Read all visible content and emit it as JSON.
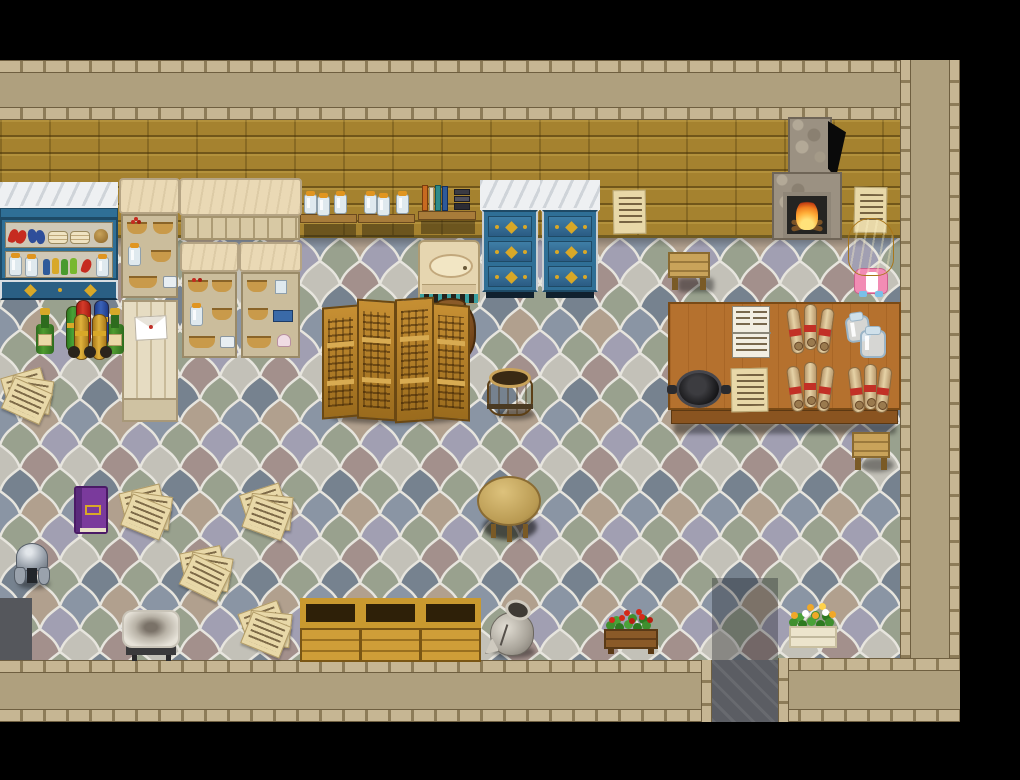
{
  "app": {
    "kind": "rpg-top-down-interior-screenshot",
    "room": "merchant shop interior with letterboard, fireplace and study table",
    "visible_text": "none (decorative pixel scribbles only)"
  },
  "palette": {
    "wall_band": "#afa07e",
    "tickA": "#c6b693",
    "wall_brick": "#a5822f",
    "furniture_blue": "#2f6f96",
    "furniture_cream": "#ead9b5",
    "accent_gold": "#d8a828",
    "table_wood": "#b5712e",
    "parchment": "#e8d8a8",
    "fire_orange": "#f08020",
    "tile_grout": "#e7e5de"
  },
  "floor": {
    "pattern": "ogee-quatrefoil tiles",
    "tile_colors": [
      "#8a95a4",
      "#b1a08e",
      "#99a18e",
      "#a19fb2",
      "#c3c1b8",
      "#a3908c",
      "#76828f"
    ]
  },
  "labels": {
    "blue_shelf": "Blue display shelf with food, plates and bottles",
    "pantry_shelf_1": "Cream pantry shelf with baskets",
    "carved_cabinet": "Wide cream cabinet with carved frieze",
    "pantry_shelf_2": "Cream pantry shelf with baskets and jars",
    "pantry_shelf_3": "Cream pantry shelf with bread and cups",
    "letter_board": "Wooden board with pinned letter",
    "wall_jar_shelf": "Wall shelves with glass jars",
    "wall_book_shelf": "Wall shelf with books",
    "washstand": "Stone washstand with basin",
    "dresser_left": "Blue dresser with lace cover",
    "dresser_right": "Blue dresser with lace cover",
    "notice_left": "Parchment notice on wall",
    "notice_right": "Parchment notice on wall",
    "fireplace": "Stone fireplace with burning fire",
    "stool_small": "Small wooden stool",
    "villager": "Blonde villager in pink dress facing the wall",
    "big_table": "Large wooden merchant table",
    "iron_pan": "Cast iron pan",
    "open_ledger": "Open ledger book",
    "price_sheet": "Parchment list",
    "scrolls_a": "Bundle of scrolls tied with red ribbon",
    "scrolls_b": "Bundle of scrolls tied with red ribbon",
    "scrolls_c": "Bundle of scrolls tied with red ribbon",
    "glass_jars": "Pair of glass jars",
    "table_stool": "Stool beside the table",
    "folding_screen": "Carved wooden folding screen",
    "large_pot": "Large clay pot behind the screen",
    "bucket": "Wooden bucket",
    "wine_bottle_1": "Green wine bottle",
    "wine_bottle_2": "Green wine bottle",
    "fabric_bolts": "Rolled fabric bolts with ribbons",
    "paper_pile": "Scattered handwritten papers",
    "purple_book": "Purple book with gold clasp",
    "helmet": "Iron helmet",
    "round_table": "Round wooden table",
    "cushion": "Worn white cushion seat",
    "crates": "Open wooden storage crates",
    "broken_vase": "Broken ceramic vase",
    "planter_red": "Planter with red flowers",
    "planter_yellow": "Planter with yellow flowers",
    "exit_south": "Doorway passage leading south",
    "exit_west": "Dark doorway at west wall"
  }
}
